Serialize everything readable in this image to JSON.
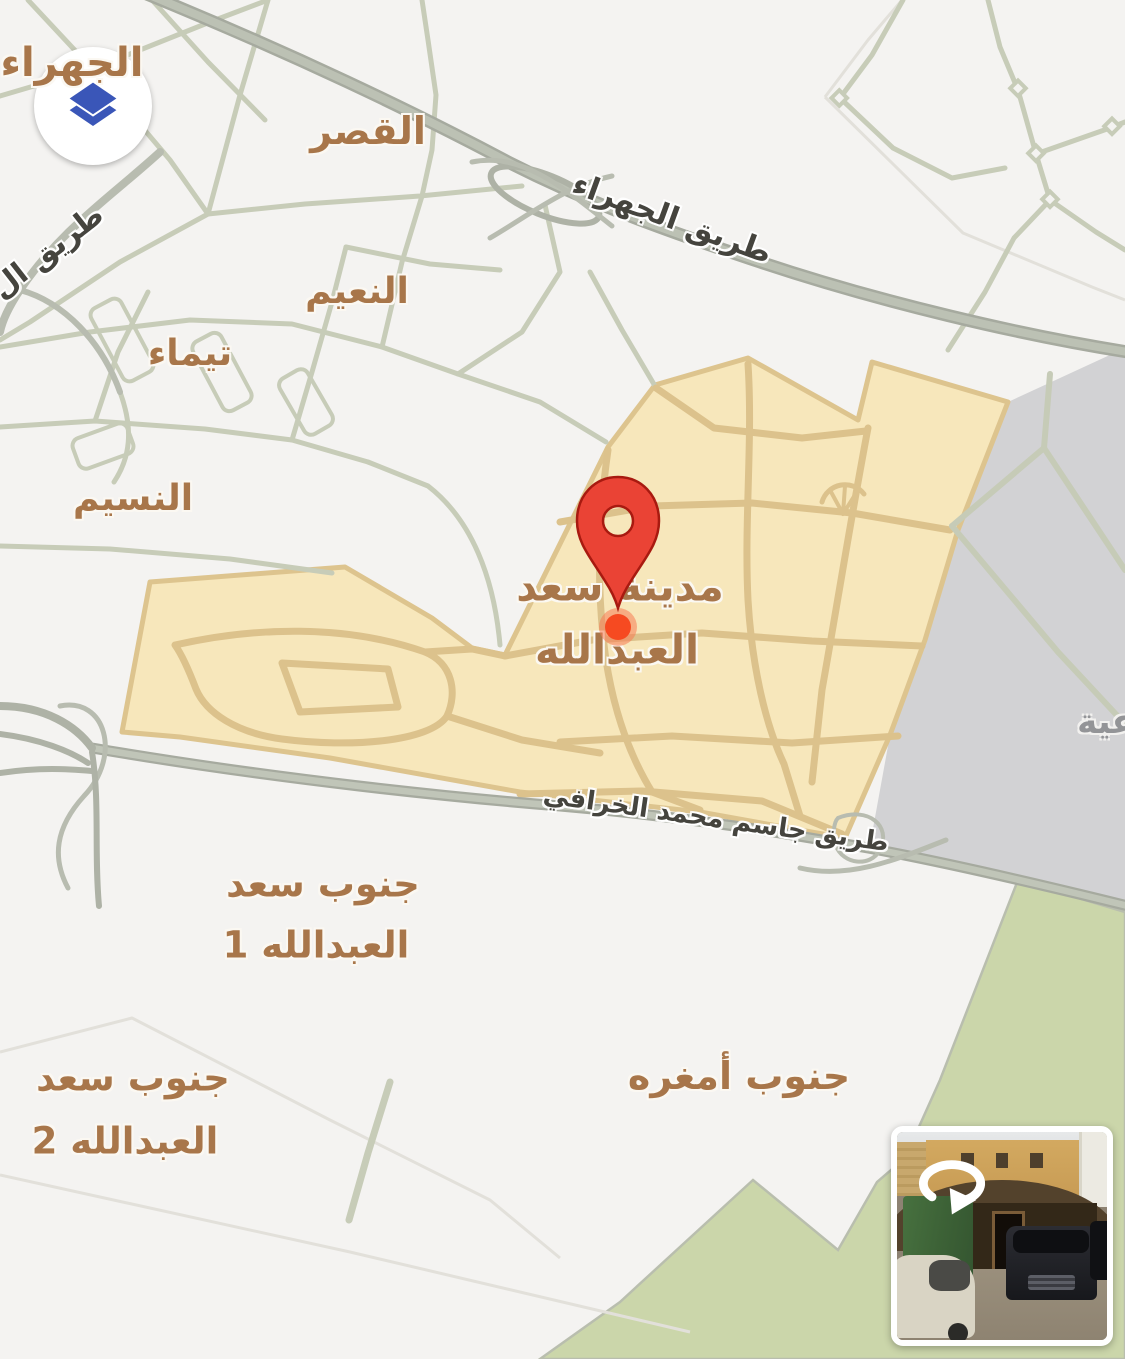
{
  "map": {
    "background_color": "#f4f3f1",
    "labels": {
      "jahra_partial": "الجهراء",
      "alqasr": "القصر",
      "alnaeem": "النعيم",
      "taima": "تيماء",
      "alnaseem": "النسيم",
      "saad_city_line1": "مدينة سعد",
      "saad_city_line2": "العبدالله",
      "south_saad1_line1": "جنوب سعد",
      "south_saad1_line2": "العبدالله 1",
      "south_saad2_line1": "جنوب سعد",
      "south_saad2_line2": "العبدالله 2",
      "south_amghara": "جنوب أمغره",
      "partial_right_edge": "عية"
    },
    "roads": {
      "jahra": "طريق الجهراء",
      "kharafi": "طريق جاسم محمد الخرافي",
      "partial_left_edge": "طريق ال"
    },
    "colors": {
      "district_label": "#a8764a",
      "road_label": "#45443e",
      "highlight_region_fill": "#f7e7bb",
      "highlight_region_roads": "#dcc28c",
      "industrial_region_fill": "#d2d2d4",
      "green_region_fill": "#cbd6aa",
      "street": "#c7ccb8",
      "highway": "#a6aa9f"
    },
    "marker": {
      "pin_color": "#ea4335",
      "dot_color": "#f64a21"
    }
  },
  "controls": {
    "layers_button": {
      "icon": "layers",
      "color": "#3a56b8"
    }
  },
  "street_view_preview": {
    "icon": "rotate-360"
  }
}
